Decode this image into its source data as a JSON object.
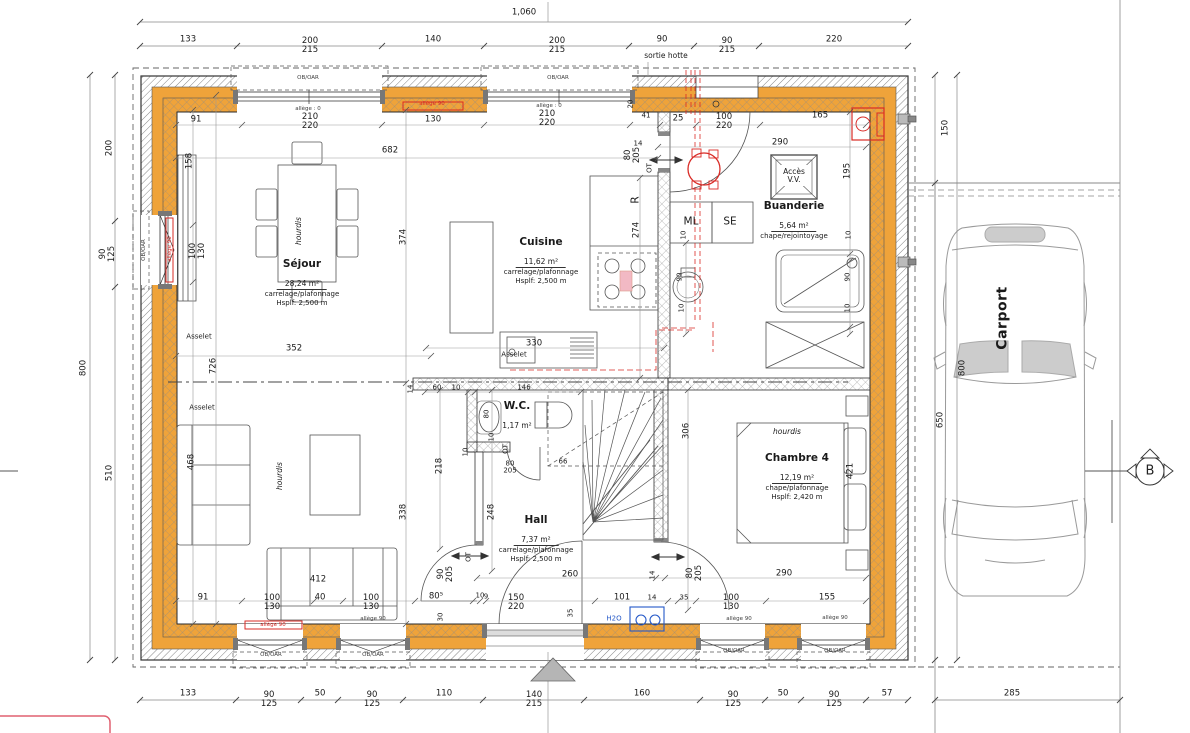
{
  "plan": {
    "rooms": [
      {
        "name": "Séjour",
        "area": "28,24 m²",
        "finish": "carrelage/plafonnage",
        "height": "Hsplf: 2,500 m"
      },
      {
        "name": "Cuisine",
        "area": "11,62 m²",
        "finish": "carrelage/plafonnage",
        "height": "Hsplf: 2,500 m"
      },
      {
        "name": "Buanderie",
        "area": "5,64 m²",
        "finish": "chape/rejointoyage",
        "height": ""
      },
      {
        "name": "W.C.",
        "area": "1,17 m²",
        "finish": "",
        "height": ""
      },
      {
        "name": "Hall",
        "area": "7,37 m²",
        "finish": "carrelage/plafonnage",
        "height": "Hsplf: 2,500 m"
      },
      {
        "name": "Chambre 4",
        "area": "12,19 m²",
        "finish": "chape/plafonnage",
        "height": "Hsplf: 2,420 m"
      },
      {
        "name": "Carport",
        "area": "",
        "finish": "",
        "height": ""
      }
    ],
    "section_marker": "B"
  },
  "colors": {
    "insulation": "#EFA33A",
    "red_accent": "#D92B26",
    "blue_accent": "#2458C8"
  },
  "dims": [
    {
      "t": "1,060",
      "x": 524,
      "y": 13
    },
    {
      "t": "133",
      "x": 188,
      "y": 40
    },
    {
      "t": "200",
      "t2": "215",
      "x": 310,
      "y": 46
    },
    {
      "t": "140",
      "x": 433,
      "y": 40
    },
    {
      "t": "200",
      "t2": "215",
      "x": 557,
      "y": 46
    },
    {
      "t": "90",
      "x": 662,
      "y": 40
    },
    {
      "t": "90",
      "t2": "215",
      "x": 727,
      "y": 46
    },
    {
      "t": "220",
      "x": 834,
      "y": 40
    },
    {
      "t": "133",
      "x": 188,
      "y": 694
    },
    {
      "t": "90",
      "t2": "125",
      "x": 269,
      "y": 700
    },
    {
      "t": "50",
      "x": 320,
      "y": 694
    },
    {
      "t": "90",
      "t2": "125",
      "x": 372,
      "y": 700
    },
    {
      "t": "110",
      "x": 444,
      "y": 694
    },
    {
      "t": "140",
      "t2": "215",
      "x": 534,
      "y": 700
    },
    {
      "t": "160",
      "x": 642,
      "y": 694
    },
    {
      "t": "90",
      "t2": "125",
      "x": 733,
      "y": 700
    },
    {
      "t": "50",
      "x": 783,
      "y": 694
    },
    {
      "t": "90",
      "t2": "125",
      "x": 834,
      "y": 700
    },
    {
      "t": "57",
      "x": 887,
      "y": 694
    },
    {
      "t": "285",
      "x": 1012,
      "y": 694
    },
    {
      "t": "800",
      "x": 84,
      "y": 368,
      "c": "rot"
    },
    {
      "t": "200",
      "x": 110,
      "y": 148,
      "c": "rot"
    },
    {
      "t": "90",
      "t2": "125",
      "x": 108,
      "y": 254,
      "c": "rot"
    },
    {
      "t": "510",
      "x": 110,
      "y": 473,
      "c": "rot"
    },
    {
      "t": "150",
      "x": 946,
      "y": 128,
      "c": "rot"
    },
    {
      "t": "800",
      "x": 963,
      "y": 368,
      "c": "rot"
    },
    {
      "t": "650",
      "x": 941,
      "y": 420,
      "c": "rot"
    },
    {
      "t": "91",
      "x": 196,
      "y": 120
    },
    {
      "t": "allège : 0",
      "x": 308,
      "y": 110,
      "c": "micro"
    },
    {
      "t": "210",
      "t2": "220",
      "x": 310,
      "y": 122
    },
    {
      "t": "130",
      "x": 433,
      "y": 120
    },
    {
      "t": "allège : 0",
      "x": 549,
      "y": 107,
      "c": "micro"
    },
    {
      "t": "210",
      "t2": "220",
      "x": 547,
      "y": 119
    },
    {
      "t": "20",
      "x": 631,
      "y": 104,
      "c": "rot tiny"
    },
    {
      "t": "41",
      "x": 646,
      "y": 116,
      "c": "tiny"
    },
    {
      "t": "25",
      "x": 678,
      "y": 119
    },
    {
      "t": "100",
      "t2": "220",
      "x": 724,
      "y": 122
    },
    {
      "t": "165",
      "x": 820,
      "y": 116
    },
    {
      "t": "682",
      "x": 390,
      "y": 151
    },
    {
      "t": "14",
      "x": 638,
      "y": 144,
      "c": "tiny"
    },
    {
      "t": "290",
      "x": 780,
      "y": 143
    },
    {
      "t": "80",
      "t2": "205",
      "x": 633,
      "y": 155,
      "c": "rot"
    },
    {
      "t": "OT",
      "x": 650,
      "y": 168,
      "c": "rot tiny"
    },
    {
      "t": "158",
      "x": 190,
      "y": 161,
      "c": "rot"
    },
    {
      "t": "100",
      "t2": "130",
      "x": 198,
      "y": 251,
      "c": "rot"
    },
    {
      "t": "374",
      "x": 404,
      "y": 237,
      "c": "rot"
    },
    {
      "t": "726",
      "x": 214,
      "y": 366,
      "c": "rot"
    },
    {
      "t": "352",
      "x": 294,
      "y": 349
    },
    {
      "t": "14",
      "x": 411,
      "y": 389,
      "c": "rot tiny"
    },
    {
      "t": "468",
      "x": 192,
      "y": 462,
      "c": "rot"
    },
    {
      "t": "338",
      "x": 404,
      "y": 512,
      "c": "rot"
    },
    {
      "t": "218",
      "x": 440,
      "y": 466,
      "c": "rot"
    },
    {
      "t": "248",
      "x": 492,
      "y": 512,
      "c": "rot"
    },
    {
      "t": "60",
      "x": 437,
      "y": 388,
      "c": "tiny"
    },
    {
      "t": "10",
      "x": 456,
      "y": 388,
      "c": "tiny"
    },
    {
      "t": "146",
      "x": 524,
      "y": 388,
      "c": "tiny"
    },
    {
      "t": "10",
      "x": 492,
      "y": 437,
      "c": "rot tiny"
    },
    {
      "t": "80",
      "x": 487,
      "y": 414,
      "c": "rot tiny"
    },
    {
      "t": "OT",
      "x": 506,
      "y": 449,
      "c": "rot tiny"
    },
    {
      "t": "80",
      "t2": "205",
      "x": 510,
      "y": 468,
      "c": "tiny"
    },
    {
      "t": "66",
      "x": 563,
      "y": 462,
      "c": "tiny"
    },
    {
      "t": "10",
      "x": 466,
      "y": 452,
      "c": "rot tiny"
    },
    {
      "t": "90",
      "t2": "205",
      "x": 446,
      "y": 574,
      "c": "rot"
    },
    {
      "t": "OT",
      "x": 469,
      "y": 557,
      "c": "rot tiny"
    },
    {
      "t": "10",
      "x": 480,
      "y": 596,
      "c": "tiny"
    },
    {
      "t": "260",
      "x": 570,
      "y": 575
    },
    {
      "t": "14",
      "x": 653,
      "y": 575,
      "c": "rot tiny"
    },
    {
      "t": "80",
      "t2": "205",
      "x": 695,
      "y": 573,
      "c": "rot"
    },
    {
      "t": "290",
      "x": 784,
      "y": 574
    },
    {
      "t": "35",
      "x": 571,
      "y": 613,
      "c": "rot tiny"
    },
    {
      "t": "30",
      "x": 441,
      "y": 617,
      "c": "rot tiny"
    },
    {
      "t": "9",
      "x": 486,
      "y": 597,
      "c": "tiny"
    },
    {
      "t": "80⁵",
      "x": 436,
      "y": 597
    },
    {
      "t": "91",
      "x": 203,
      "y": 598
    },
    {
      "t": "100",
      "t2": "130",
      "x": 272,
      "y": 603
    },
    {
      "t": "40",
      "x": 320,
      "y": 598
    },
    {
      "t": "100",
      "t2": "130",
      "x": 371,
      "y": 603
    },
    {
      "t": "412",
      "x": 318,
      "y": 580
    },
    {
      "t": "150",
      "t2": "220",
      "x": 516,
      "y": 603
    },
    {
      "t": "101",
      "x": 622,
      "y": 598
    },
    {
      "t": "14",
      "x": 652,
      "y": 598,
      "c": "tiny"
    },
    {
      "t": "35",
      "x": 684,
      "y": 598,
      "c": "tiny"
    },
    {
      "t": "100",
      "t2": "130",
      "x": 731,
      "y": 603
    },
    {
      "t": "155",
      "x": 827,
      "y": 598
    },
    {
      "t": "274",
      "x": 637,
      "y": 230,
      "c": "rot"
    },
    {
      "t": "330",
      "x": 534,
      "y": 344
    },
    {
      "t": "306",
      "x": 687,
      "y": 431,
      "c": "rot"
    },
    {
      "t": "421",
      "x": 851,
      "y": 471,
      "c": "rot"
    },
    {
      "t": "195",
      "x": 848,
      "y": 171,
      "c": "rot"
    },
    {
      "t": "10",
      "x": 684,
      "y": 235,
      "c": "rot tiny"
    },
    {
      "t": "10",
      "x": 849,
      "y": 235,
      "c": "rot tiny"
    },
    {
      "t": "90",
      "x": 680,
      "y": 277,
      "c": "rot tiny"
    },
    {
      "t": "10",
      "x": 682,
      "y": 308,
      "c": "rot tiny"
    },
    {
      "t": "90",
      "x": 848,
      "y": 277,
      "c": "rot tiny"
    },
    {
      "t": "10",
      "x": 848,
      "y": 308,
      "c": "rot tiny"
    }
  ],
  "notes": [
    {
      "t": "sortie hotte",
      "x": 666,
      "y": 56,
      "c": "small"
    },
    {
      "t": "Asselet",
      "x": 199,
      "y": 337,
      "c": "tiny"
    },
    {
      "t": "Asselet",
      "x": 202,
      "y": 408,
      "c": "tiny"
    },
    {
      "t": "Asselet",
      "x": 514,
      "y": 355,
      "c": "tiny"
    },
    {
      "t": "hourdis",
      "x": 299,
      "y": 231,
      "c": "rot italic small"
    },
    {
      "t": "hourdis",
      "x": 280,
      "y": 476,
      "c": "rot italic small"
    },
    {
      "t": "hourdis",
      "x": 787,
      "y": 432,
      "c": "italic small"
    },
    {
      "t": "ML",
      "x": 691,
      "y": 222,
      "c": "appl"
    },
    {
      "t": "SE",
      "x": 730,
      "y": 222,
      "c": "appl"
    },
    {
      "t": "Accès",
      "t2": "V.V.",
      "x": 794,
      "y": 176,
      "c": "small"
    },
    {
      "t": "H2O",
      "x": 614,
      "y": 619,
      "c": "blue tiny"
    },
    {
      "t": "R",
      "x": 636,
      "y": 200,
      "c": "rot appl"
    },
    {
      "t": "OB/OAR",
      "x": 308,
      "y": 79,
      "c": "micro"
    },
    {
      "t": "OB/OAR",
      "x": 558,
      "y": 79,
      "c": "micro"
    },
    {
      "t": "OB/OAR",
      "x": 145,
      "y": 250,
      "c": "rot micro"
    },
    {
      "t": "OB/OAR",
      "x": 271,
      "y": 656,
      "c": "micro"
    },
    {
      "t": "OB/OAR",
      "x": 373,
      "y": 656,
      "c": "micro"
    },
    {
      "t": "OB/OAR",
      "x": 734,
      "y": 652,
      "c": "micro"
    },
    {
      "t": "OB/OAR",
      "x": 835,
      "y": 652,
      "c": "micro"
    },
    {
      "t": "allège 90",
      "x": 273,
      "y": 626,
      "c": "micro red"
    },
    {
      "t": "allège 90",
      "x": 373,
      "y": 620,
      "c": "micro"
    },
    {
      "t": "allège 90",
      "x": 739,
      "y": 620,
      "c": "micro"
    },
    {
      "t": "allège 90",
      "x": 835,
      "y": 619,
      "c": "micro"
    },
    {
      "t": "allège 90",
      "x": 171,
      "y": 249,
      "c": "rot micro red"
    },
    {
      "t": "allège 90",
      "x": 432,
      "y": 105,
      "c": "micro red"
    }
  ]
}
